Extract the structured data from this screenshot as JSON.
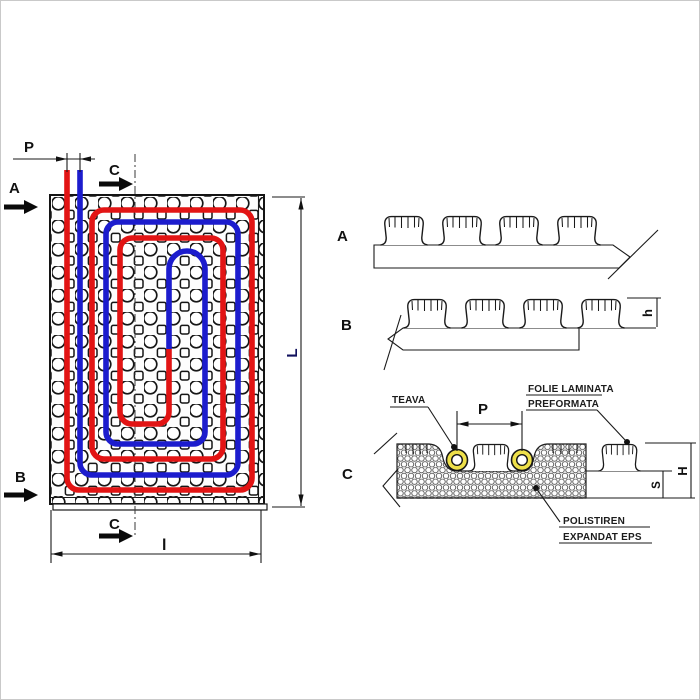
{
  "figure": {
    "plan_view": {
      "pitch_label": "P",
      "section_a_marker": "A",
      "section_b_marker": "B",
      "section_c_marker_top": "C",
      "section_c_marker_bottom": "C",
      "length_dim": "L",
      "width_dim": "l"
    },
    "profile_a": {
      "label": "A"
    },
    "profile_b": {
      "label": "B",
      "stud_height_dim": "h"
    },
    "profile_c": {
      "label": "C",
      "pipe_callout": "TEAVA",
      "pipe_pitch_dim": "P",
      "foil_callout_line1": "FOLIE LAMINATA",
      "foil_callout_line2": "PREFORMATA",
      "eps_callout_line1": "POLISTIREN",
      "eps_callout_line2": "EXPANDAT EPS",
      "screed_dim": "S",
      "total_height_dim": "H"
    },
    "colors": {
      "supply_pipe": "#e21414",
      "return_pipe": "#1c1ccd",
      "pipe_ring": "#eee04a",
      "length_label": "#11115e"
    }
  }
}
